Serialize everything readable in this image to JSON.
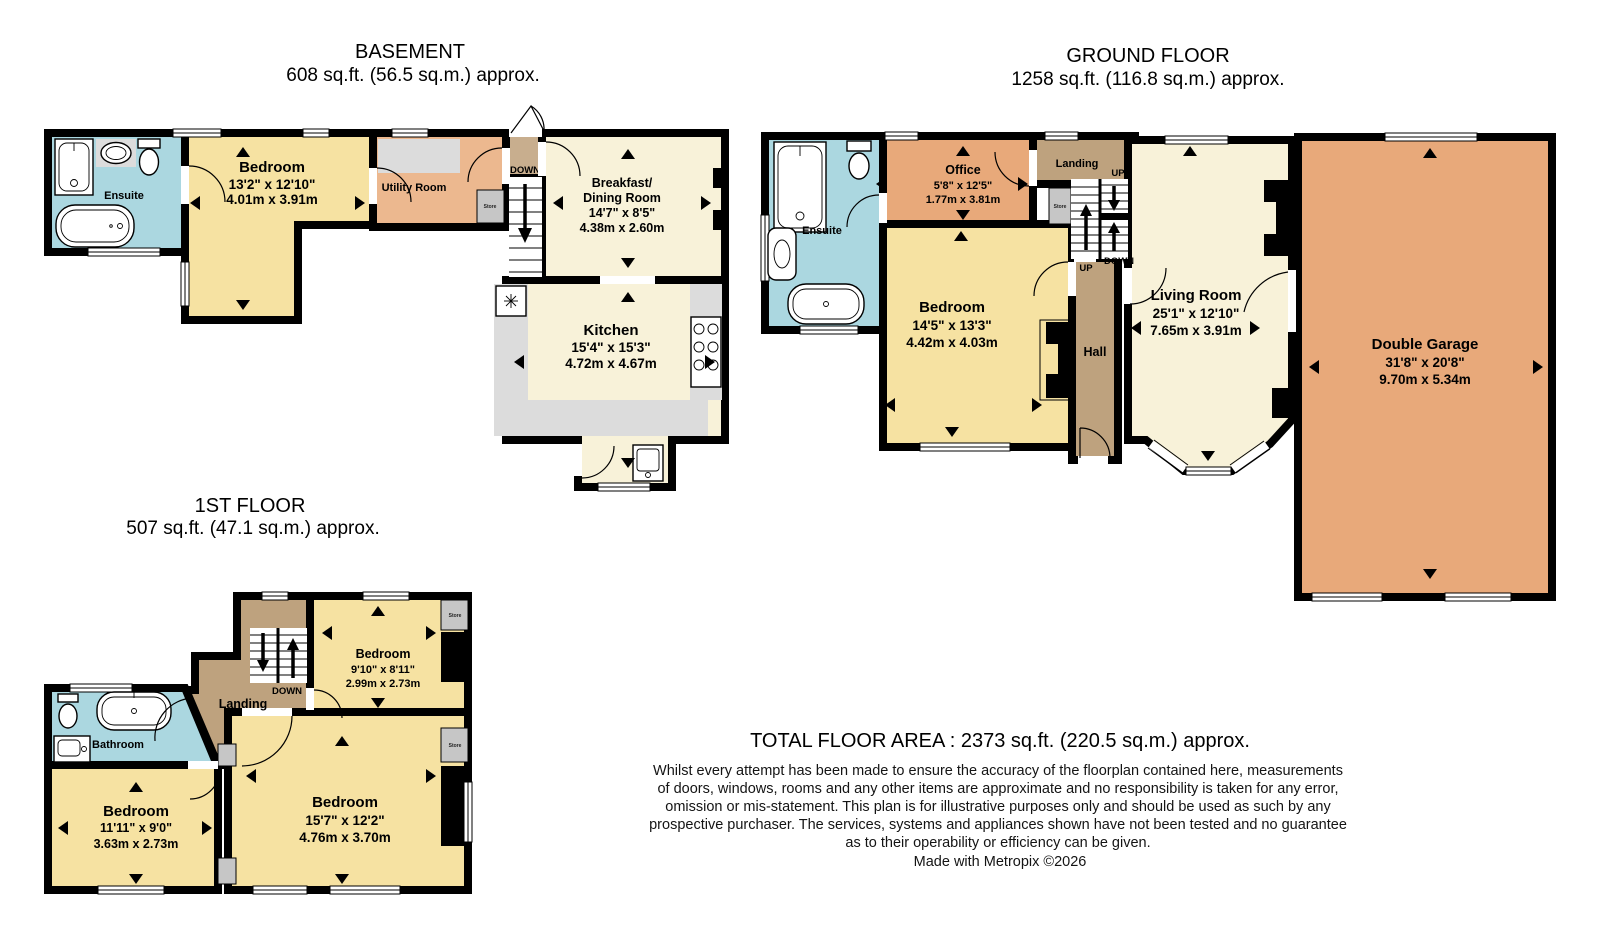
{
  "palette": {
    "room_yellow": "#F6E2A2",
    "room_cream": "#F8F2D9",
    "room_orange": "#E8A97A",
    "room_orange_light": "#ECB88F",
    "room_blue": "#ABD7E0",
    "hall_brown": "#BEA27E",
    "entry_tan": "#C8AE8E",
    "store_gray": "#C6C6C6",
    "counter_gray": "#DCDCDC",
    "title_gray": "#7B7B7B",
    "text_black": "#141414"
  },
  "labels": {
    "up": "UP",
    "down": "DOWN",
    "store": "Store"
  },
  "basement": {
    "title": "BASEMENT",
    "area": "608 sq.ft. (56.5 sq.m.) approx.",
    "rooms": {
      "ensuite": {
        "name": "Ensuite"
      },
      "bedroom": {
        "name": "Bedroom",
        "imperial": "13'2\" x 12'10\"",
        "metric": "4.01m x 3.91m"
      },
      "utility": {
        "name": "Utility Room"
      },
      "breakfast": {
        "name_line1": "Breakfast/",
        "name_line2": "Dining Room",
        "imperial": "14'7\" x 8'5\"",
        "metric": "4.38m x 2.60m"
      },
      "kitchen": {
        "name": "Kitchen",
        "imperial": "15'4\" x 15'3\"",
        "metric": "4.72m x 4.67m"
      }
    }
  },
  "ground_floor": {
    "title": "GROUND FLOOR",
    "area": "1258 sq.ft. (116.8 sq.m.) approx.",
    "rooms": {
      "ensuite": {
        "name": "Ensuite"
      },
      "office": {
        "name": "Office",
        "imperial": "5'8\" x 12'5\"",
        "metric": "1.77m x 3.81m"
      },
      "landing": {
        "name": "Landing"
      },
      "bedroom": {
        "name": "Bedroom",
        "imperial": "14'5\" x 13'3\"",
        "metric": "4.42m x 4.03m"
      },
      "hall": {
        "name": "Hall"
      },
      "living": {
        "name": "Living Room",
        "imperial": "25'1\" x 12'10\"",
        "metric": "7.65m x 3.91m"
      },
      "garage": {
        "name": "Double Garage",
        "imperial": "31'8\" x 20'8\"",
        "metric": "9.70m x 5.34m"
      }
    }
  },
  "first_floor": {
    "title": "1ST FLOOR",
    "area": "507 sq.ft. (47.1 sq.m.) approx.",
    "rooms": {
      "bedroom_small": {
        "name": "Bedroom",
        "imperial": "9'10\" x 8'11\"",
        "metric": "2.99m x 2.73m"
      },
      "bathroom": {
        "name": "Bathroom"
      },
      "landing": {
        "name": "Landing"
      },
      "bedroom_left": {
        "name": "Bedroom",
        "imperial": "11'11\" x 9'0\"",
        "metric": "3.63m x 2.73m"
      },
      "bedroom_big": {
        "name": "Bedroom",
        "imperial": "15'7\" x 12'2\"",
        "metric": "4.76m x 3.70m"
      }
    }
  },
  "footer": {
    "total_area": "TOTAL FLOOR AREA : 2373 sq.ft. (220.5 sq.m.) approx.",
    "disclaimer_lines": [
      "Whilst every attempt has been made to ensure the accuracy of the floorplan contained here, measurements",
      "of doors, windows, rooms and any other items are approximate and no responsibility is taken for any error,",
      "omission or mis-statement. This plan is for illustrative purposes only and should be used as such by any",
      "prospective purchaser. The services, systems and appliances shown have not been tested and no guarantee",
      "as to their operability or efficiency can be given."
    ],
    "credit": "Made with Metropix ©2026"
  }
}
